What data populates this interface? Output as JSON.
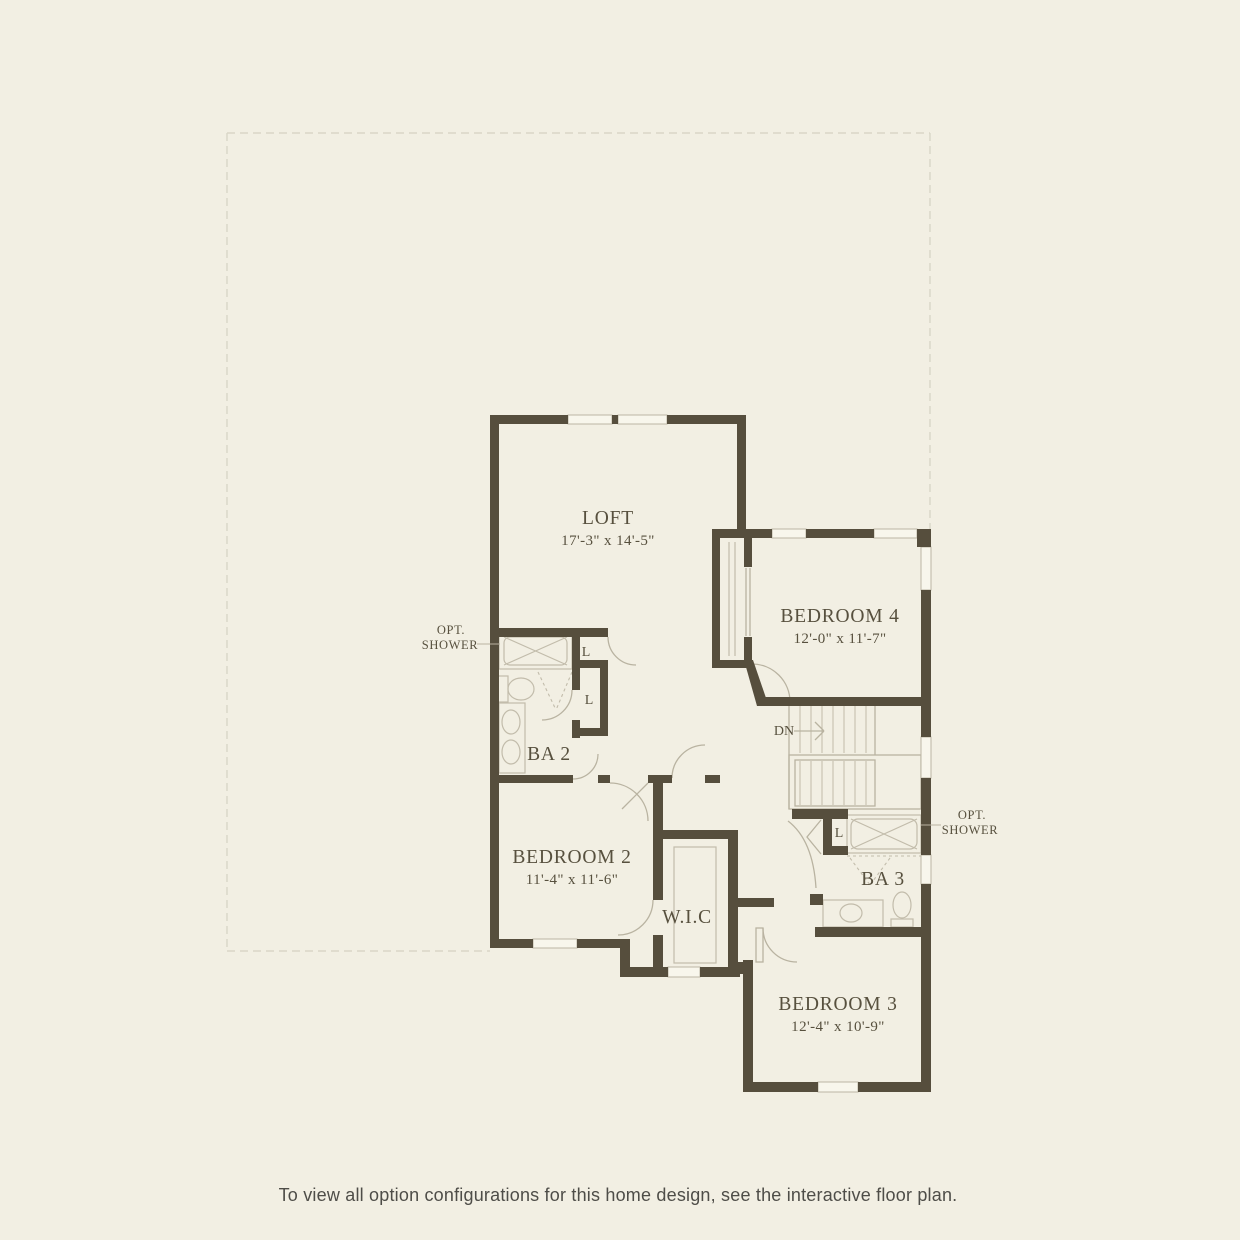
{
  "colors": {
    "background": "#f2efe3",
    "walls": "#564e3d",
    "thin_lines": "#b9b3a1",
    "window_fill": "#f8f6ec",
    "property_dash": "#d9d6c7",
    "label_text": "#57503e",
    "caption_text": "#4e4d48"
  },
  "plan": {
    "rooms": {
      "loft": {
        "label": "LOFT",
        "dims": "17'-3\" x 14'-5\""
      },
      "bedroom4": {
        "label": "BEDROOM 4",
        "dims": "12'-0\" x 11'-7\""
      },
      "bedroom2": {
        "label": "BEDROOM 2",
        "dims": "11'-4\" x 11'-6\""
      },
      "bedroom3": {
        "label": "BEDROOM 3",
        "dims": "12'-4\" x 10'-9\""
      },
      "bath2": {
        "label": "BA 2"
      },
      "bath3": {
        "label": "BA 3"
      },
      "wic": {
        "label": "W.I.C"
      }
    },
    "annotations": {
      "opt_shower_left": {
        "line1": "OPT.",
        "line2": "SHOWER"
      },
      "opt_shower_right": {
        "line1": "OPT.",
        "line2": "SHOWER"
      },
      "down": "DN",
      "linen": "L"
    }
  },
  "caption": "To view all option configurations for this home design, see the interactive floor plan."
}
